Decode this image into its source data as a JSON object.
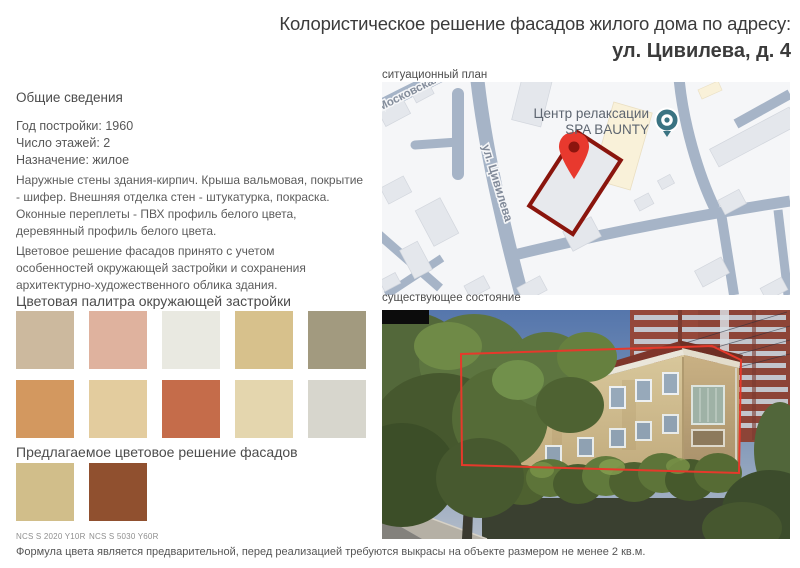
{
  "title": {
    "line1": "Колористическое решение фасадов жилого дома по адресу:",
    "line2": "ул. Цивилева, д. 4"
  },
  "general": {
    "heading": "Общие сведения",
    "facts": [
      "Год постройки: 1960",
      "Число этажей: 2",
      "Назначение: жилое"
    ],
    "description": "Наружные стены здания-кирпич. Крыша вальмовая, покрытие - шифер. Внешняя отделка стен - штукатурка, покраска. Оконные переплеты - ПВХ профиль белого цвета, деревянный профиль белого цвета.",
    "context_note": "Цветовое решение фасадов принято с учетом особенностей окружающей застройки и сохранения архитектурно-художественного облика здания."
  },
  "palette": {
    "heading": "Цветовая палитра окружающей застройки",
    "colors": [
      "#ccb99e",
      "#dfb29e",
      "#e9e9e1",
      "#d7c18c",
      "#a29a7f",
      "#d3985f",
      "#e3cc9e",
      "#c56c4a",
      "#e4d6ae",
      "#d7d6cd"
    ]
  },
  "proposed": {
    "heading": "Предлагаемое цветовое решение фасадов",
    "swatches": [
      {
        "label": "NCS S 2020 Y10R",
        "color": "#d1be8a"
      },
      {
        "label": "NCS S 5030 Y60R",
        "color": "#90502f"
      }
    ]
  },
  "map": {
    "heading": "ситуационный план",
    "poi": {
      "line1": "Центр релаксации",
      "line2": "SPA BAUNTY"
    },
    "streets": [
      "Московская",
      "ул. Цивилева"
    ]
  },
  "photo": {
    "heading": "существующее состояние"
  },
  "footnote": "Формула цвета является предварительной, перед реализацией требуются выкрасы на объекте размером не менее 2 кв.м.",
  "colors": {
    "annotation_red": "#e6392b",
    "plot_outline_red": "#8a150d",
    "marker_red": "#e8392e",
    "map_street": "#a6b4c7",
    "poi_teal": "#3a7382"
  }
}
